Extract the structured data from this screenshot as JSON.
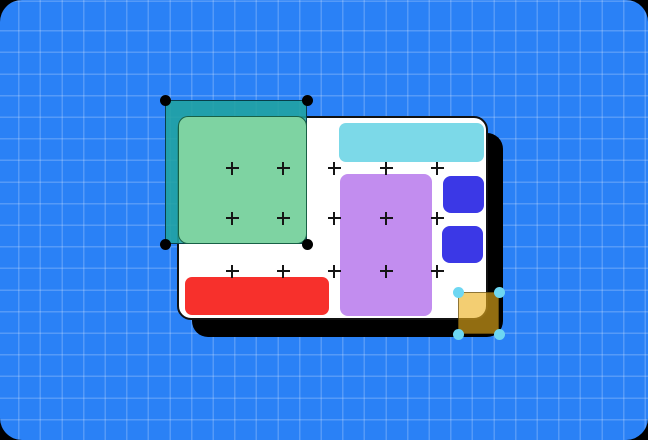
{
  "canvas": {
    "background_color": "#2A81F6",
    "grid_line_color": "rgba(255,255,255,0.20)",
    "corner_backdrop_color": "#000000"
  },
  "artboard": {
    "background_color": "#FFFFFF",
    "border_color": "#111111",
    "shadow_color": "#000000",
    "plus_mark_color": "#151515",
    "shapes": {
      "cyan_bar": "#7CD9E8",
      "purple_rect": "#C28DEF",
      "blue_square_top": "#3B38E6",
      "blue_square_bottom": "#3B38E6",
      "red_bar": "#F7302C"
    }
  },
  "selection_green": {
    "marquee_fill": "rgba(32,163,160,0.88)",
    "marquee_border": "rgba(4,52,64,0.9)",
    "shape_fill": "#7ED3A2",
    "shape_border": "rgba(13,84,60,0.9)",
    "handle_color": "#000000",
    "handle_shape": "circle"
  },
  "selection_yellow": {
    "shape_fill": "rgba(235,176,28,0.62)",
    "shape_border": "rgba(58,44,8,0.55)",
    "handle_color": "#6ED7F2",
    "handle_shape": "circle"
  }
}
